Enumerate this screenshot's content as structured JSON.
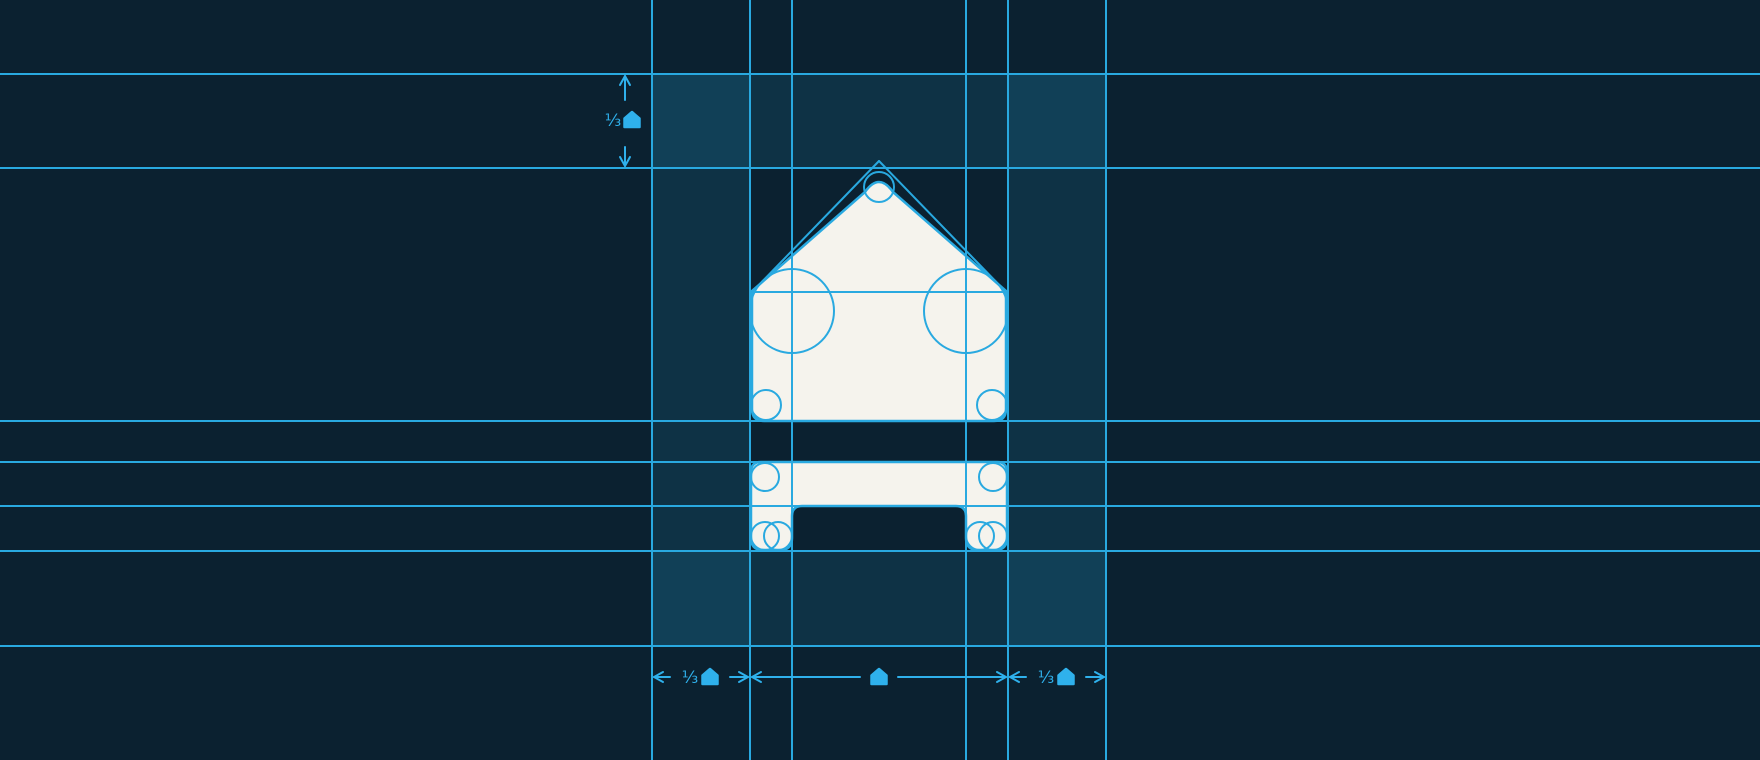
{
  "canvas": {
    "width": 1760,
    "height": 760
  },
  "colors": {
    "background": "#0b2130",
    "grid_line": "#29a9e0",
    "accent": "#2fb1ec",
    "highlight_fill": "#29abe2",
    "highlight_opacity": 0.12,
    "logo_fill": "#f5f3ed",
    "logo_stroke": "#29a9e0"
  },
  "grid": {
    "vertical_lines": [
      652,
      750,
      792,
      966,
      1008,
      1106
    ],
    "horizontal_lines": [
      74,
      168,
      421,
      462,
      506,
      551,
      646
    ],
    "construction_segments": [
      {
        "name": "roof-baseline",
        "x1": 752,
        "y1": 292,
        "x2": 1006,
        "y2": 292
      },
      {
        "name": "roof-left-slope",
        "x1": 879,
        "y1": 161,
        "x2": 752,
        "y2": 292
      },
      {
        "name": "roof-right-slope",
        "x1": 879,
        "y1": 161,
        "x2": 1006,
        "y2": 292
      }
    ]
  },
  "clear_space_bands": [
    {
      "name": "top-margin-band",
      "x": 652,
      "y": 74,
      "w": 454,
      "h": 94
    },
    {
      "name": "bottom-margin-band",
      "x": 652,
      "y": 551,
      "w": 454,
      "h": 95
    },
    {
      "name": "left-margin-band",
      "x": 652,
      "y": 74,
      "w": 98,
      "h": 572
    },
    {
      "name": "right-margin-band",
      "x": 1008,
      "y": 74,
      "w": 98,
      "h": 572
    }
  ],
  "logo": {
    "roof_path": "M 865 192 Q 879 172 893 192 L 1006 291 L 1006 409 Q 1006 421 994 421 L 764 421 Q 752 421 752 409 L 752 291 Z",
    "base_path": "M 751 472 Q 751 462 761 462 L 997 462 Q 1007 462 1007 472 L 1007 538 Q 1007 550 995 550 L 978 550 Q 966 550 966 538 L 966 516 Q 966 506 956 506 L 802 506 Q 792 506 792 516 L 792 538 Q 792 550 780 550 L 763 550 Q 751 550 751 538 Z"
  },
  "construction_circles": [
    {
      "cx": 879,
      "cy": 187,
      "r": 15
    },
    {
      "cx": 792,
      "cy": 311,
      "r": 42
    },
    {
      "cx": 966,
      "cy": 311,
      "r": 42
    },
    {
      "cx": 766,
      "cy": 405,
      "r": 15
    },
    {
      "cx": 992,
      "cy": 405,
      "r": 15
    },
    {
      "cx": 765,
      "cy": 477,
      "r": 14
    },
    {
      "cx": 993,
      "cy": 477,
      "r": 14
    },
    {
      "cx": 765,
      "cy": 536,
      "r": 14
    },
    {
      "cx": 778,
      "cy": 536,
      "r": 14
    },
    {
      "cx": 980,
      "cy": 536,
      "r": 14
    },
    {
      "cx": 993,
      "cy": 536,
      "r": 14
    }
  ],
  "dimensions": {
    "vertical": {
      "x": 625,
      "y1": 74,
      "y2": 168,
      "gap1": 100,
      "gap2": 147,
      "label": "⅓",
      "label_text_x": 613,
      "glyph_x": 632,
      "label_y": 120
    },
    "horizontal": {
      "y": 677,
      "spans": [
        {
          "x1": 652,
          "x2": 750,
          "label": "⅓",
          "gap1": 670,
          "gap2": 730,
          "label_text_x": 690,
          "glyph_x": 710
        },
        {
          "x1": 750,
          "x2": 1008,
          "label": "",
          "gap1": 860,
          "gap2": 898,
          "label_text_x": 0,
          "glyph_x": 879
        },
        {
          "x1": 1008,
          "x2": 1106,
          "label": "⅓",
          "gap1": 1026,
          "gap2": 1086,
          "label_text_x": 1046,
          "glyph_x": 1066
        }
      ]
    }
  }
}
